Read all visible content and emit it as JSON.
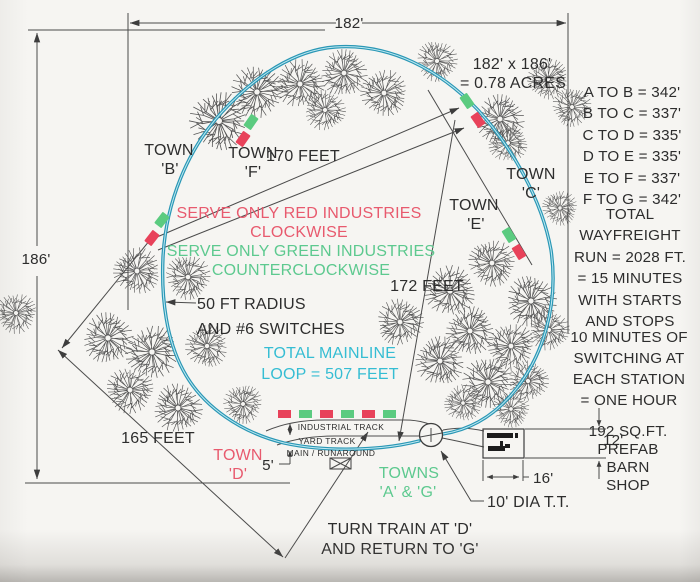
{
  "colors": {
    "paper": "#f6f5f2",
    "ink": "#2d2d2d",
    "line": "#4b4b4b",
    "track": "#2a97b5",
    "track_core": "#bfe9f2",
    "red_text": "#e85a6e",
    "green_text": "#5dc98f",
    "cyan_text": "#35bdd3",
    "marker_red": "#e8425a",
    "marker_green": "#5bcb80"
  },
  "dimensions": {
    "width_label": "182'",
    "height_label": "186'",
    "area_line1": "182' x 186'",
    "area_line2": "= 0.78 ACRES",
    "chord_bc": "170 FEET",
    "chord_cd": "172 FEET",
    "chord_corner": "165 FEET",
    "track_spacing": "5'",
    "barn_depth": "12'",
    "barn_width": "16'",
    "turntable": "10' DIA T.T."
  },
  "towns": {
    "b1": "TOWN",
    "b2": "'B'",
    "f1": "TOWN",
    "f2": "'F'",
    "c1": "TOWN",
    "c2": "'C'",
    "e1": "TOWN",
    "e2": "'E'",
    "d1": "TOWN",
    "d2": "'D'",
    "ag1": "TOWNS",
    "ag2": "'A' & 'G'"
  },
  "notes": {
    "red1": "SERVE ONLY RED INDUSTRIES",
    "red2": "CLOCKWISE",
    "green1": "SERVE ONLY GREEN INDUSTRIES",
    "green2": "COUNTERCLOCKWISE",
    "radius1": "50 FT RADIUS",
    "radius2": "AND #6 SWITCHES",
    "mainline1": "TOTAL MAINLINE",
    "mainline2": "LOOP = 507 FEET",
    "turn1": "TURN TRAIN AT 'D'",
    "turn2": "AND RETURN TO 'G'"
  },
  "track_labels": {
    "industrial": "INDUSTRIAL TRACK",
    "yard": "YARD TRACK",
    "main": "MAIN / RUNAROUND"
  },
  "station_distances": [
    "A TO B = 342'",
    "B TO C = 337'",
    "C TO D = 335'",
    "D TO E = 335'",
    "E TO F = 337'",
    "F TO G = 342'"
  ],
  "wayfreight_note": [
    "TOTAL",
    "WAYFREIGHT",
    "RUN = 2028 FT.",
    "= 15 MINUTES",
    "WITH STARTS",
    "AND STOPS"
  ],
  "switching_note": [
    "10 MINUTES OF",
    "SWITCHING AT",
    "EACH STATION",
    "= ONE HOUR"
  ],
  "barn_note": [
    "192 SQ.FT.",
    "PREFAB",
    "BARN",
    "SHOP"
  ],
  "diagram": {
    "trees": [
      {
        "x": 219,
        "y": 121,
        "r": 30,
        "a": 0
      },
      {
        "x": 257,
        "y": 92,
        "r": 27,
        "a": 40
      },
      {
        "x": 300,
        "y": 84,
        "r": 25,
        "a": 80
      },
      {
        "x": 344,
        "y": 73,
        "r": 24,
        "a": 200
      },
      {
        "x": 384,
        "y": 93,
        "r": 24,
        "a": 120
      },
      {
        "x": 325,
        "y": 110,
        "r": 21,
        "a": 300
      },
      {
        "x": 437,
        "y": 61,
        "r": 21,
        "a": 160
      },
      {
        "x": 500,
        "y": 119,
        "r": 25,
        "a": 200
      },
      {
        "x": 548,
        "y": 79,
        "r": 21,
        "a": 240
      },
      {
        "x": 572,
        "y": 107,
        "r": 20,
        "a": 30
      },
      {
        "x": 508,
        "y": 143,
        "r": 20,
        "a": 90
      },
      {
        "x": 560,
        "y": 208,
        "r": 18,
        "a": 130
      },
      {
        "x": 137,
        "y": 271,
        "r": 24,
        "a": 110
      },
      {
        "x": 188,
        "y": 277,
        "r": 23,
        "a": 150
      },
      {
        "x": 16,
        "y": 313,
        "r": 21,
        "a": 260
      },
      {
        "x": 108,
        "y": 338,
        "r": 26,
        "a": 190
      },
      {
        "x": 152,
        "y": 352,
        "r": 27,
        "a": 230
      },
      {
        "x": 130,
        "y": 390,
        "r": 24,
        "a": 270
      },
      {
        "x": 178,
        "y": 408,
        "r": 25,
        "a": 310
      },
      {
        "x": 207,
        "y": 346,
        "r": 22,
        "a": 350
      },
      {
        "x": 243,
        "y": 404,
        "r": 20,
        "a": 15
      },
      {
        "x": 400,
        "y": 322,
        "r": 24,
        "a": 55
      },
      {
        "x": 450,
        "y": 291,
        "r": 26,
        "a": 95
      },
      {
        "x": 492,
        "y": 263,
        "r": 24,
        "a": 135
      },
      {
        "x": 531,
        "y": 301,
        "r": 26,
        "a": 175
      },
      {
        "x": 470,
        "y": 331,
        "r": 25,
        "a": 215
      },
      {
        "x": 511,
        "y": 346,
        "r": 24,
        "a": 255
      },
      {
        "x": 549,
        "y": 330,
        "r": 21,
        "a": 295
      },
      {
        "x": 440,
        "y": 361,
        "r": 25,
        "a": 335
      },
      {
        "x": 488,
        "y": 382,
        "r": 26,
        "a": 20
      },
      {
        "x": 528,
        "y": 381,
        "r": 21,
        "a": 60
      },
      {
        "x": 463,
        "y": 403,
        "r": 19,
        "a": 100
      },
      {
        "x": 511,
        "y": 409,
        "r": 19,
        "a": 140
      }
    ],
    "station_markers": [
      {
        "x": 162,
        "y": 220,
        "rot": 38,
        "c": "green"
      },
      {
        "x": 152,
        "y": 238,
        "rot": 38,
        "c": "red"
      },
      {
        "x": 251,
        "y": 122,
        "rot": 35,
        "c": "green"
      },
      {
        "x": 243,
        "y": 139,
        "rot": 35,
        "c": "red"
      },
      {
        "x": 467,
        "y": 101,
        "rot": -35,
        "c": "green"
      },
      {
        "x": 478,
        "y": 120,
        "rot": -35,
        "c": "red"
      },
      {
        "x": 509,
        "y": 235,
        "rot": -32,
        "c": "green"
      },
      {
        "x": 519,
        "y": 252,
        "rot": -32,
        "c": "red"
      }
    ],
    "industry_dashes": {
      "y": 410,
      "w": 13,
      "h": 8,
      "items": [
        {
          "x": 278,
          "c": "red"
        },
        {
          "x": 299,
          "c": "green"
        },
        {
          "x": 320,
          "c": "red"
        },
        {
          "x": 341,
          "c": "green"
        },
        {
          "x": 362,
          "c": "red"
        },
        {
          "x": 383,
          "c": "green"
        }
      ]
    }
  }
}
